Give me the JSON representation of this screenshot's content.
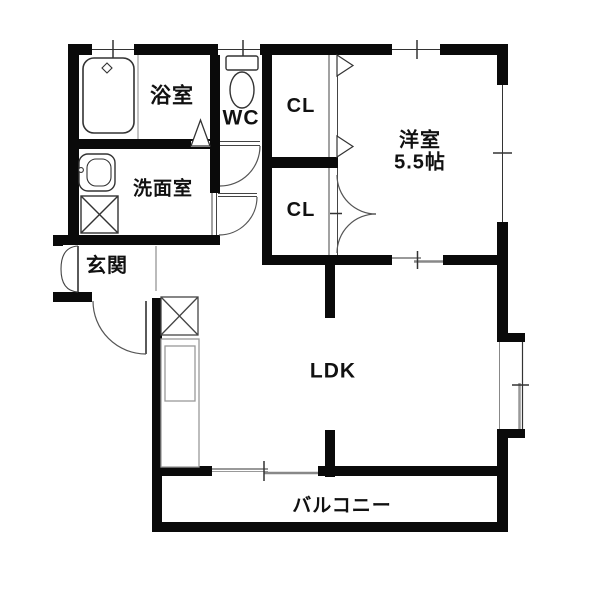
{
  "floorplan": {
    "colors": {
      "background": "#ffffff",
      "wall": "#0a0a0a",
      "fixture_line": "#333333",
      "detail_line": "#888888",
      "text": "#111111"
    },
    "rooms": {
      "bathroom": {
        "label": "浴室"
      },
      "toilet": {
        "label": "WC"
      },
      "washroom": {
        "label": "洗面室"
      },
      "entrance": {
        "label": "玄関"
      },
      "closet_upper": {
        "label": "CL"
      },
      "closet_lower": {
        "label": "CL"
      },
      "western_room": {
        "label": "洋室",
        "size": "5.5帖"
      },
      "ldk": {
        "label": "LDK"
      },
      "balcony": {
        "label": "バルコニー"
      }
    }
  }
}
